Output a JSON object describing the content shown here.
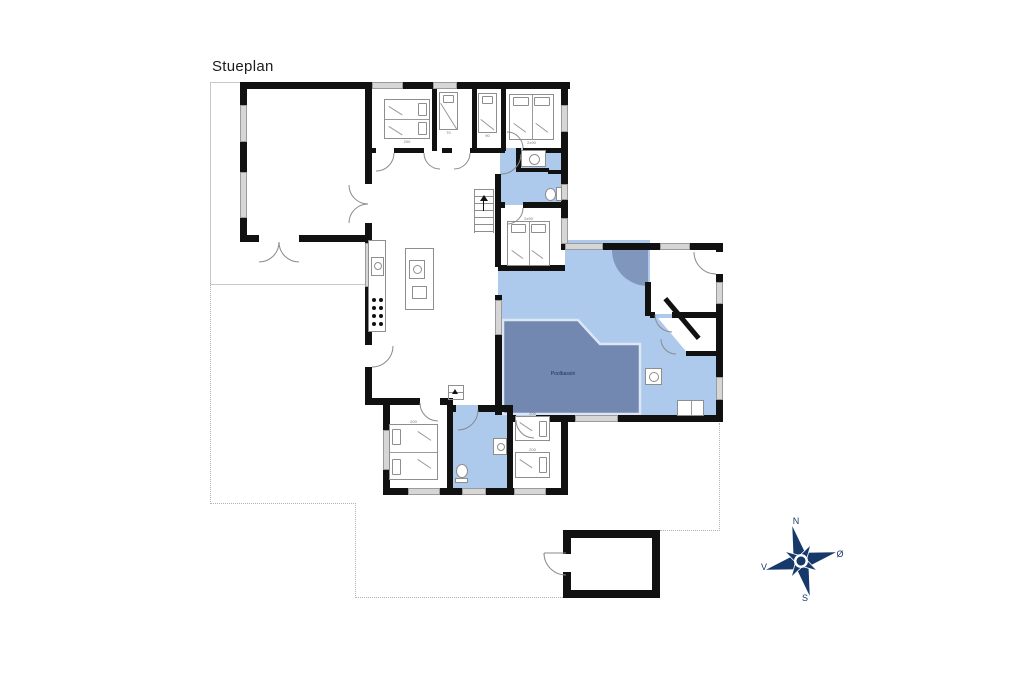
{
  "title": "Stueplan",
  "floor_plan": {
    "pool_label": "Poolbassin"
  },
  "compass": {
    "north": "N",
    "east": "Ø",
    "south": "S",
    "west": "V"
  },
  "beds": {
    "bed1": {
      "size": "200"
    },
    "bed2": {
      "size": "70"
    },
    "bed3": {
      "size": "90"
    },
    "bed4": {
      "size": "2x90"
    },
    "bed5": {
      "size": "2x90"
    },
    "bed6": {
      "size": "200"
    },
    "bed7a": {
      "size": "200"
    },
    "bed7b": {
      "size": "200"
    }
  },
  "colors": {
    "wall": "#111111",
    "room_fill": "#adc9ec",
    "pool_fill": "#7288b0",
    "door_swing_fill": "#8096bc",
    "window": "#d6d6d6",
    "terrace_line": "#c9c9c9",
    "compass": "#17386b",
    "background": "#ffffff"
  }
}
